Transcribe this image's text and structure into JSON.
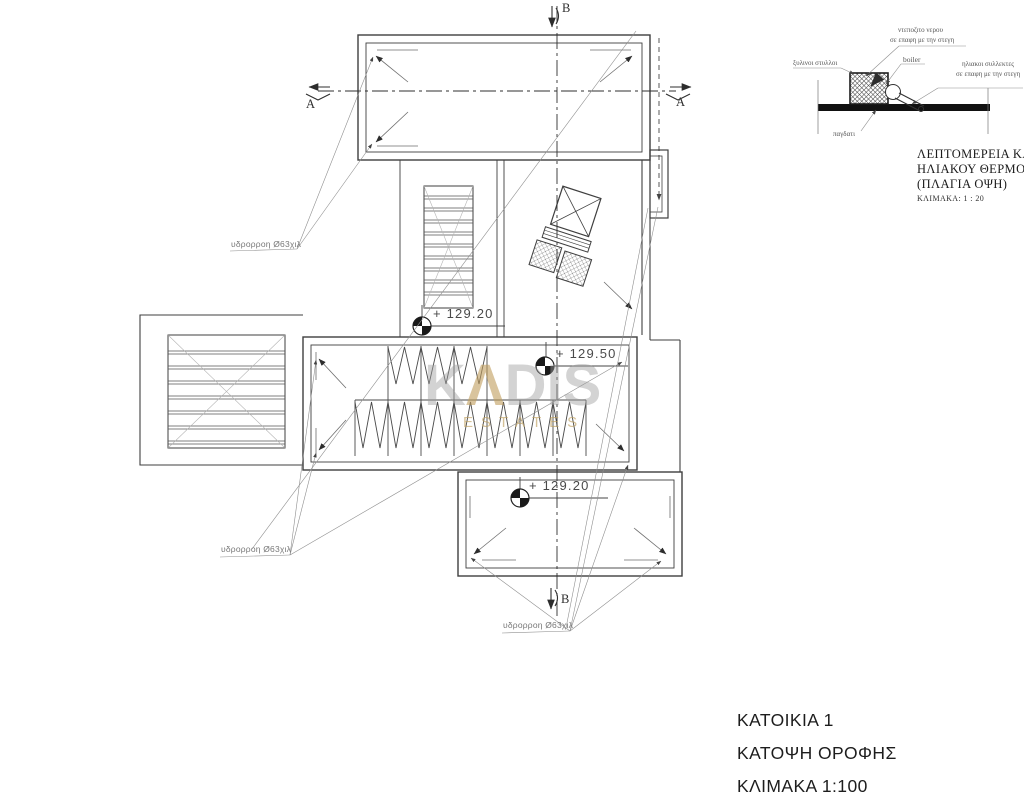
{
  "watermark": {
    "k": "K",
    "a": "Λ",
    "dis": "DIS",
    "estates": "ESTATES"
  },
  "plan": {
    "downpipe_labels": [
      {
        "text": "υδρορροη Ø63χιλ"
      },
      {
        "text": "υδρορροη Ø63χιλ"
      },
      {
        "text": "υδρορροη Ø63χιλ"
      }
    ],
    "levels": [
      {
        "text": "+ 129.20"
      },
      {
        "text": "+ 129.50"
      },
      {
        "text": "+ 129.20"
      }
    ],
    "sections": {
      "a_left": "A",
      "a_right": "A",
      "b_top": "B",
      "b_bottom": "B"
    }
  },
  "detail": {
    "labels": {
      "tank1": "ντεποζιτο νερου",
      "tank2": "σε επαφη με την στεγη",
      "boiler": "boiler",
      "collectors1": "ηλιακοι συλλεκτες",
      "collectors2": "σε επαφη με την στεγη",
      "posts": "ξυλινοι στυλλοι",
      "base": "παγδατι"
    },
    "title": {
      "line1": "ΛΕΠΤΟΜΕΡΕΙΑ ΚΑΛΥΨ",
      "line2": "ΗΛΙΑΚΟΥ ΘΕΡΜΟΣΥΦΩ",
      "line3": "(ΠΛΑΓΙΑ ΟΨΗ)",
      "scale": "ΚΛΙΜΑΚΑ: 1 : 20"
    }
  },
  "title_block": {
    "house": "ΚΑΤΟΙΚΙΑ 1",
    "drawing": "ΚΑΤΟΨΗ ΟΡΟΦΗΣ",
    "scale": "ΚΛΙΜΑΚΑ 1:100"
  },
  "colors": {
    "line": "#3f3f3f",
    "hairline": "#999999",
    "accent_gold": "#bf9d5c",
    "watermark_gray": "#9e9e9e"
  }
}
